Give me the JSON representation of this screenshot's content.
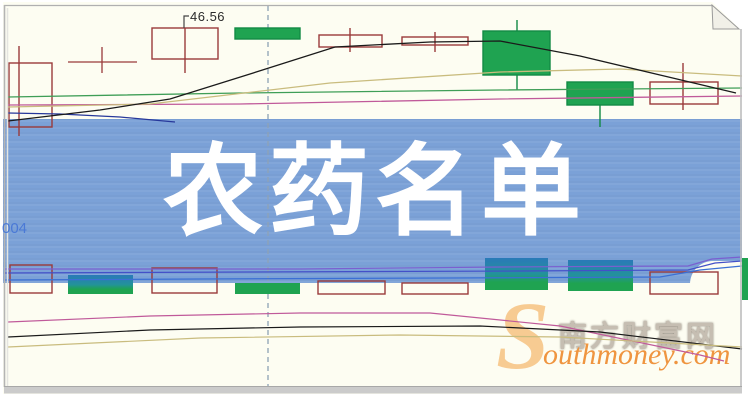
{
  "banner": {
    "title": "农药名单",
    "bg_color": "#7ba1d7",
    "text_color": "#ffffff"
  },
  "annotations": {
    "price_label": "46.56",
    "code_label": "004"
  },
  "watermark": {
    "initial": "S",
    "cn": "南方财富网",
    "rest": "outhmoney.com",
    "orange": "#ef9540",
    "light_orange": "#f7cb92",
    "gray": "#c6beb2"
  },
  "frame": {
    "bg": "#fdfdf2",
    "border": "#bfbfbf",
    "fold_corner": "top-right"
  },
  "chart_data": {
    "type": "candlestick",
    "title": "",
    "axes_visible": false,
    "grid": false,
    "legend": false,
    "price_label": 46.56,
    "dashed_vline_x": 268,
    "colors": {
      "bull_outline": "#9a3b3b",
      "bear": "#1fa351",
      "bear_edge": "#128a44",
      "bear_top": "#2a79b8",
      "ma_black": "#1a1a1a",
      "ma_green": "#3f9e57",
      "ma_magenta": "#c05a9a",
      "ma_khaki": "#c9bc7e",
      "ma_navy": "#27389b",
      "vol_violet": "#7a5fd0",
      "vol_indigo": "#4450c8",
      "vol_blue": "#3b6fd4",
      "dashed": "#8ea2b5",
      "pointer": "#444444"
    },
    "candles": [
      {
        "x": 9,
        "y": 63,
        "w": 43,
        "h": 64,
        "kind": "hollow",
        "wx": 19,
        "wt": 46,
        "wb": 136
      },
      {
        "x": 152,
        "y": 28,
        "w": 66,
        "h": 31,
        "kind": "hollow",
        "wx": 185,
        "wt": 28,
        "wb": 73
      },
      {
        "x": 235,
        "y": 28,
        "w": 65,
        "h": 11,
        "kind": "green",
        "wx": 267,
        "wt": 28,
        "wb": 39
      },
      {
        "x": 319,
        "y": 35,
        "w": 63,
        "h": 12,
        "kind": "hollow",
        "wx": 350,
        "wt": 28,
        "wb": 52
      },
      {
        "x": 402,
        "y": 37,
        "w": 66,
        "h": 8,
        "kind": "hollow",
        "wx": 435,
        "wt": 32,
        "wb": 52
      },
      {
        "x": 483,
        "y": 31,
        "w": 67,
        "h": 44,
        "kind": "green",
        "wx": 517,
        "wt": 20,
        "wb": 90
      },
      {
        "x": 567,
        "y": 82,
        "w": 66,
        "h": 23,
        "kind": "green",
        "wx": 600,
        "wt": 82,
        "wb": 127
      },
      {
        "x": 650,
        "y": 82,
        "w": 68,
        "h": 22,
        "kind": "hollow",
        "wx": 683,
        "wt": 63,
        "wb": 110
      }
    ],
    "doji": {
      "hx1": 68,
      "hx2": 137,
      "hy": 62,
      "vx": 102,
      "vy1": 47,
      "vy2": 73
    },
    "pointer_line": [
      [
        184,
        28
      ],
      [
        184,
        16
      ],
      [
        189,
        16
      ]
    ],
    "ma_top": [
      {
        "color": "ma_green",
        "pts": [
          [
            8,
            97
          ],
          [
            240,
            93
          ],
          [
            500,
            90
          ],
          [
            742,
            88
          ]
        ]
      },
      {
        "color": "ma_magenta",
        "pts": [
          [
            8,
            105
          ],
          [
            240,
            104
          ],
          [
            500,
            99
          ],
          [
            742,
            96
          ]
        ]
      },
      {
        "color": "ma_khaki",
        "pts": [
          [
            8,
            107
          ],
          [
            150,
            104
          ],
          [
            330,
            83
          ],
          [
            500,
            72
          ],
          [
            620,
            69
          ],
          [
            742,
            76
          ]
        ]
      },
      {
        "color": "ma_navy",
        "pts": [
          [
            8,
            113
          ],
          [
            60,
            114
          ],
          [
            120,
            117
          ],
          [
            175,
            122
          ]
        ]
      },
      {
        "color": "ma_black",
        "pts": [
          [
            8,
            121
          ],
          [
            100,
            110
          ],
          [
            170,
            99
          ],
          [
            250,
            74
          ],
          [
            335,
            47
          ],
          [
            430,
            42
          ],
          [
            500,
            41
          ],
          [
            580,
            56
          ],
          [
            660,
            75
          ],
          [
            736,
            93
          ]
        ]
      }
    ],
    "volume_bars": [
      {
        "x": 10,
        "w": 42,
        "t": 265,
        "b": 293,
        "kind": "outline"
      },
      {
        "x": 68,
        "w": 65,
        "t": 275,
        "b": 294,
        "kind": "grad"
      },
      {
        "x": 152,
        "w": 65,
        "t": 268,
        "b": 293,
        "kind": "outline"
      },
      {
        "x": 235,
        "w": 65,
        "t": 283,
        "b": 294,
        "kind": "green"
      },
      {
        "x": 318,
        "w": 67,
        "t": 281,
        "b": 294,
        "kind": "outline"
      },
      {
        "x": 402,
        "w": 66,
        "t": 283,
        "b": 294,
        "kind": "outline"
      },
      {
        "x": 485,
        "w": 63,
        "t": 258,
        "b": 290,
        "kind": "grad"
      },
      {
        "x": 568,
        "w": 65,
        "t": 260,
        "b": 291,
        "kind": "grad"
      },
      {
        "x": 650,
        "w": 68,
        "t": 272,
        "b": 294,
        "kind": "outline"
      },
      {
        "x": 742,
        "w": 6,
        "t": 258,
        "b": 300,
        "kind": "green"
      }
    ],
    "vol_lines": [
      {
        "color": "vol_violet",
        "pts": [
          [
            4,
            269
          ],
          [
            300,
            269
          ],
          [
            500,
            267
          ],
          [
            688,
            266
          ],
          [
            712,
            259
          ],
          [
            742,
            257
          ]
        ]
      },
      {
        "color": "vol_indigo",
        "pts": [
          [
            4,
            273
          ],
          [
            250,
            272
          ],
          [
            520,
            271
          ],
          [
            688,
            270
          ],
          [
            715,
            263
          ],
          [
            742,
            261
          ]
        ]
      },
      {
        "color": "vol_blue",
        "pts": [
          [
            4,
            280
          ],
          [
            200,
            279
          ],
          [
            450,
            278
          ],
          [
            660,
            277
          ],
          [
            700,
            270
          ],
          [
            742,
            266
          ]
        ]
      }
    ],
    "ma_bottom": [
      {
        "color": "ma_magenta",
        "pts": [
          [
            8,
            322
          ],
          [
            150,
            316
          ],
          [
            300,
            313
          ],
          [
            430,
            313
          ],
          [
            560,
            326
          ],
          [
            700,
            355
          ],
          [
            724,
            361
          ]
        ]
      },
      {
        "color": "ma_black",
        "pts": [
          [
            8,
            337
          ],
          [
            150,
            330
          ],
          [
            300,
            327
          ],
          [
            480,
            326
          ],
          [
            600,
            332
          ],
          [
            742,
            349
          ]
        ]
      },
      {
        "color": "ma_khaki",
        "pts": [
          [
            8,
            347
          ],
          [
            200,
            338
          ],
          [
            400,
            335
          ],
          [
            560,
            337
          ],
          [
            742,
            347
          ]
        ]
      }
    ]
  }
}
